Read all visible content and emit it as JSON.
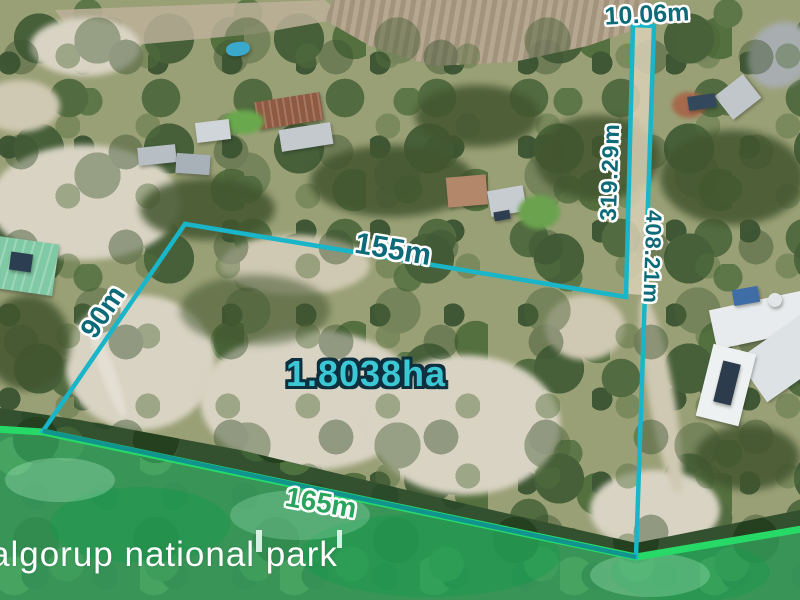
{
  "labels": {
    "frontage": "10.06m",
    "corridor_west": "319.29m",
    "east_boundary": "408.21m",
    "north_boundary": "155m",
    "west_boundary": "90m",
    "south_boundary": "165m",
    "area": "1.8038ha",
    "park_name": "algorup national park"
  },
  "colors": {
    "boundary_teal_line": "#19b5c9",
    "boundary_south_line": "#12948e",
    "park_green_line": "#27da68",
    "park_tint_green": "#3fd87f",
    "dimension_text": "#0d6a78",
    "dimension_text_outline": "#ffffff",
    "area_text": "#3bc8d4",
    "area_text_outline": "#0e2f3e",
    "south_dimension_text": "#2aa45c",
    "park_name_text": "#ffffff"
  }
}
